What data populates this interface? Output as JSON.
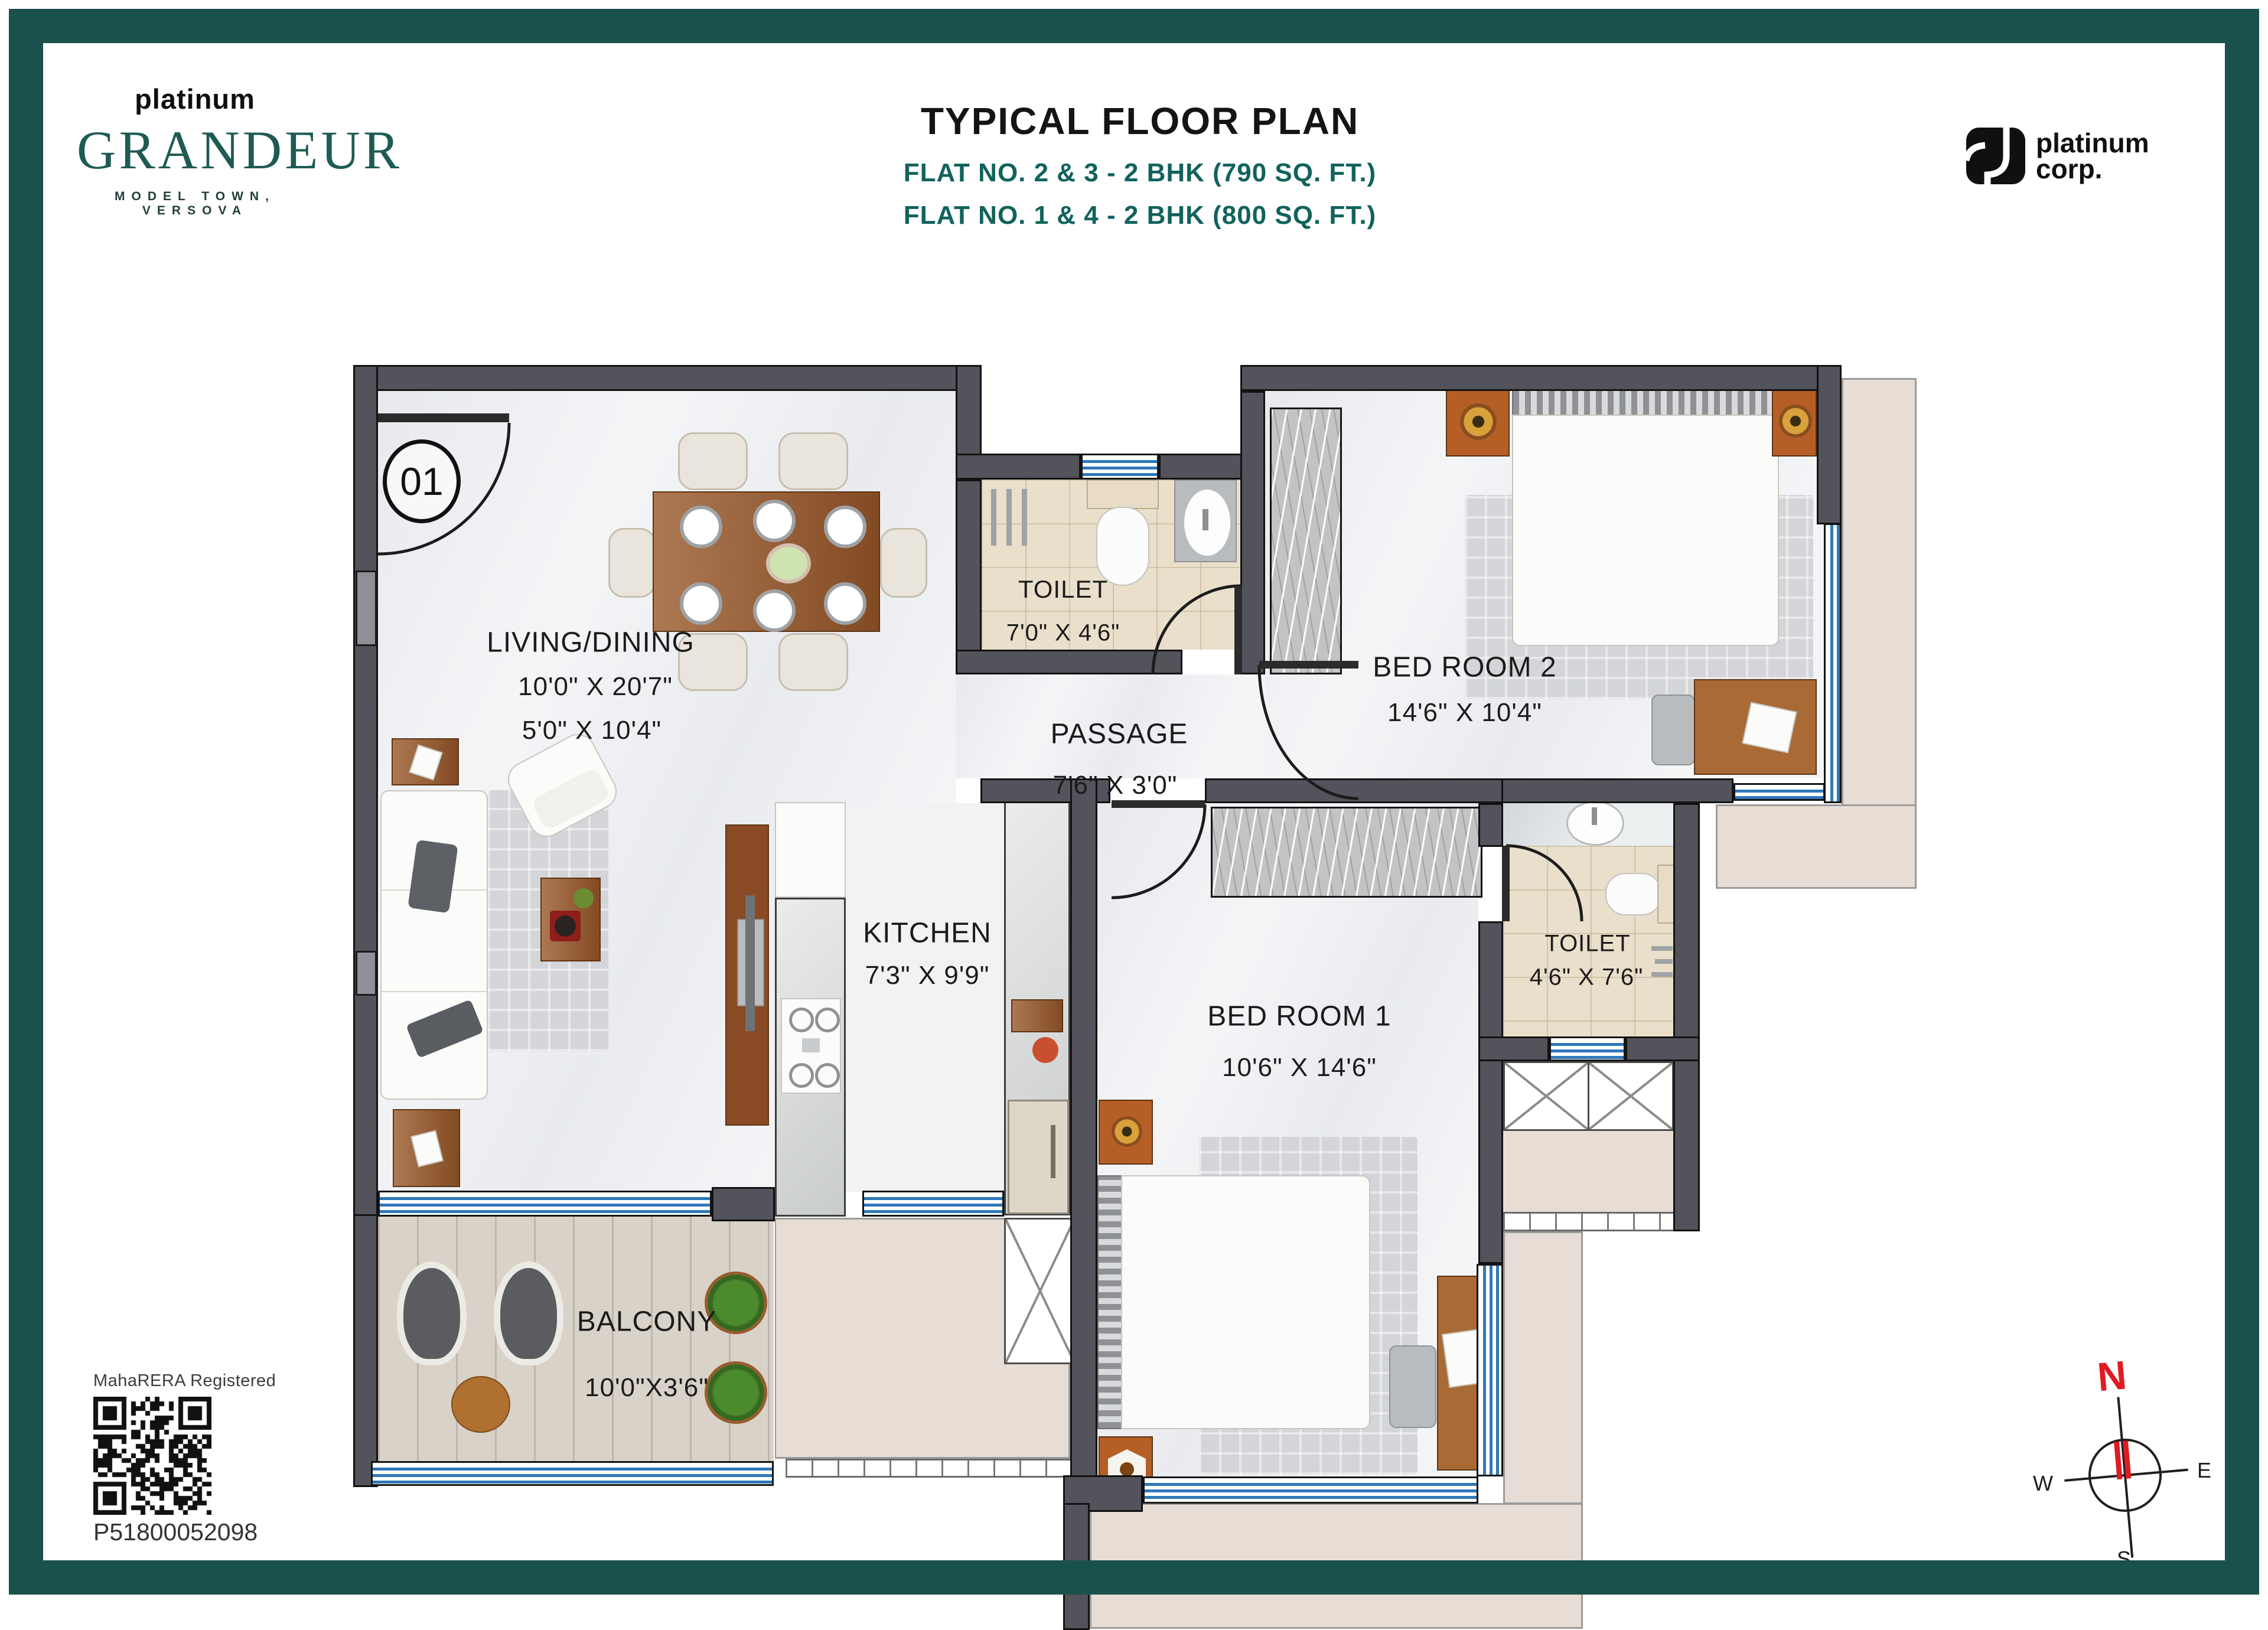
{
  "header": {
    "brand": {
      "pre": "platinum",
      "name": "GRANDEUR",
      "tagline": "MODEL TOWN, VERSOVA"
    },
    "title": "TYPICAL FLOOR PLAN",
    "subtitle1": "FLAT NO. 2 & 3 - 2 BHK (790 SQ. FT.)",
    "subtitle2": "FLAT NO. 1 & 4 - 2 BHK (800 SQ. FT.)",
    "corp": {
      "line1": "platinum",
      "line2": "corp."
    }
  },
  "plan": {
    "unit_number": "01",
    "rooms": {
      "living": {
        "name": "LIVING/DINING",
        "dim1": "10'0\" X 20'7\"",
        "dim2": "5'0\" X 10'4\""
      },
      "toilet1": {
        "name": "TOILET",
        "dim": "7'0\" X 4'6\""
      },
      "passage": {
        "name": "PASSAGE",
        "dim": "7'6\" X 3'0\""
      },
      "bedroom2": {
        "name": "BED ROOM 2",
        "dim": "14'6\" X 10'4\""
      },
      "kitchen": {
        "name": "KITCHEN",
        "dim": "7'3\" X 9'9\""
      },
      "bedroom1": {
        "name": "BED ROOM 1",
        "dim": "10'6\" X 14'6\""
      },
      "toilet2": {
        "name": "TOILET",
        "dim": "4'6\" X 7'6\""
      },
      "balcony": {
        "name": "BALCONY",
        "dim": "10'0\"X3'6\""
      }
    }
  },
  "footer": {
    "rera_label": "MahaRERA Registered",
    "rera_number": "P51800052098"
  },
  "compass": {
    "n": "N",
    "e": "E",
    "s": "S",
    "w": "W"
  },
  "colors": {
    "accent_teal": "#1b514d",
    "text_teal": "#11635c",
    "wall": "#53535b",
    "window_blue": "#2e78b8",
    "toilet_beige": "#eadfca",
    "ledge_beige": "#e7ddd4",
    "wood_brown": "#9a5b2d",
    "compass_red": "#e01b22"
  }
}
